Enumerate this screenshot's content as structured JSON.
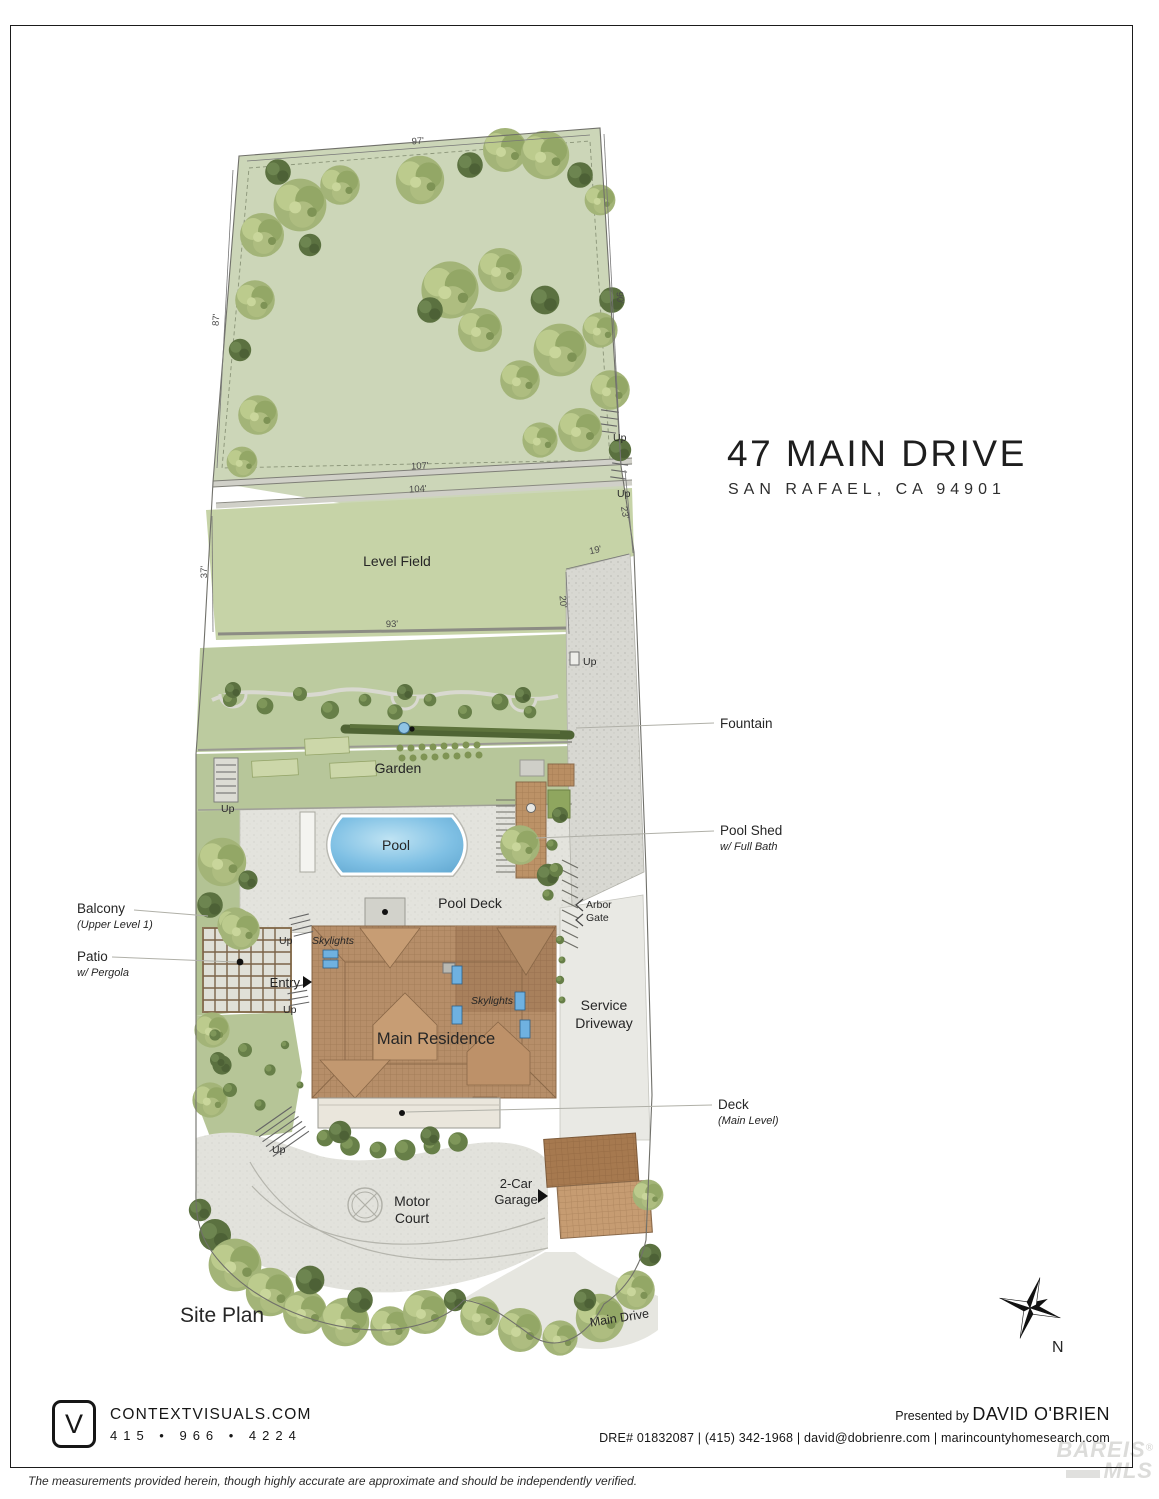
{
  "title": {
    "line1": "47 MAIN DRIVE",
    "line2": "SAN RAFAEL, CA 94901"
  },
  "plan": {
    "site_plan": "Site Plan",
    "level_field": "Level Field",
    "garden": "Garden",
    "pool": "Pool",
    "pool_deck": "Pool Deck",
    "main_residence": "Main Residence",
    "service_line1": "Service",
    "service_line2": "Driveway",
    "motor_line1": "Motor",
    "motor_line2": "Court",
    "garage_line1": "2-Car",
    "garage_line2": "Garage",
    "main_drive": "Main Drive",
    "entry": "Entry",
    "arbor_line1": "Arbor",
    "arbor_line2": "Gate",
    "skylights": "Skylights",
    "up": "Up"
  },
  "dimensions": {
    "top": "97'",
    "left_upper": "87'",
    "right_upper": "90'",
    "wall_upper": "107'",
    "wall_lower": "104'",
    "field_left": "37'",
    "field_bottom": "93'",
    "field_right": "23'",
    "drive_diag": "19'",
    "drive_side": "20'"
  },
  "callouts": {
    "fountain": {
      "label": "Fountain"
    },
    "pool_shed": {
      "label": "Pool Shed",
      "sub": "w/ Full Bath"
    },
    "balcony": {
      "label": "Balcony",
      "sub": "(Upper Level 1)"
    },
    "patio": {
      "label": "Patio",
      "sub": "w/ Pergola"
    },
    "deck": {
      "label": "Deck",
      "sub": "(Main Level)"
    }
  },
  "compass": {
    "north": "N"
  },
  "icons": {
    "entry_arrow": "right-triangle",
    "garage_arrow": "right-triangle",
    "arbor_gate_chevrons": "left-chevrons",
    "compass_rose": "8-point-star",
    "cv_logo": "rounded-square-V"
  },
  "palette": {
    "lawn": "#ccd6b8",
    "field": "#c6d3a7",
    "terrace": "#bccb9f",
    "garden": "#b7c69a",
    "paving": "#e3e3dd",
    "driveway": "#d8d8d2",
    "pool_blue": "#7fc0e4",
    "roof_brown": "#b68e69",
    "roof_dark": "#a8805c",
    "hedge_green": "#4f6434",
    "ink": "#262626"
  },
  "footer": {
    "logo_letter": "V",
    "company": "CONTEXTVISUALS.COM",
    "phone": "415 • 966 • 4224",
    "presented_by": "Presented by ",
    "agent": "DAVID O'BRIEN",
    "credentials": "DRE# 01832087  |  (415) 342-1968  |  david@dobrienre.com  |  marincountyhomesearch.com",
    "watermark_line1": "BAREIS",
    "watermark_reg": "®",
    "watermark_line2": "MLS"
  },
  "disclaimer": "The measurements provided herein, though highly accurate are approximate and should be independently verified."
}
